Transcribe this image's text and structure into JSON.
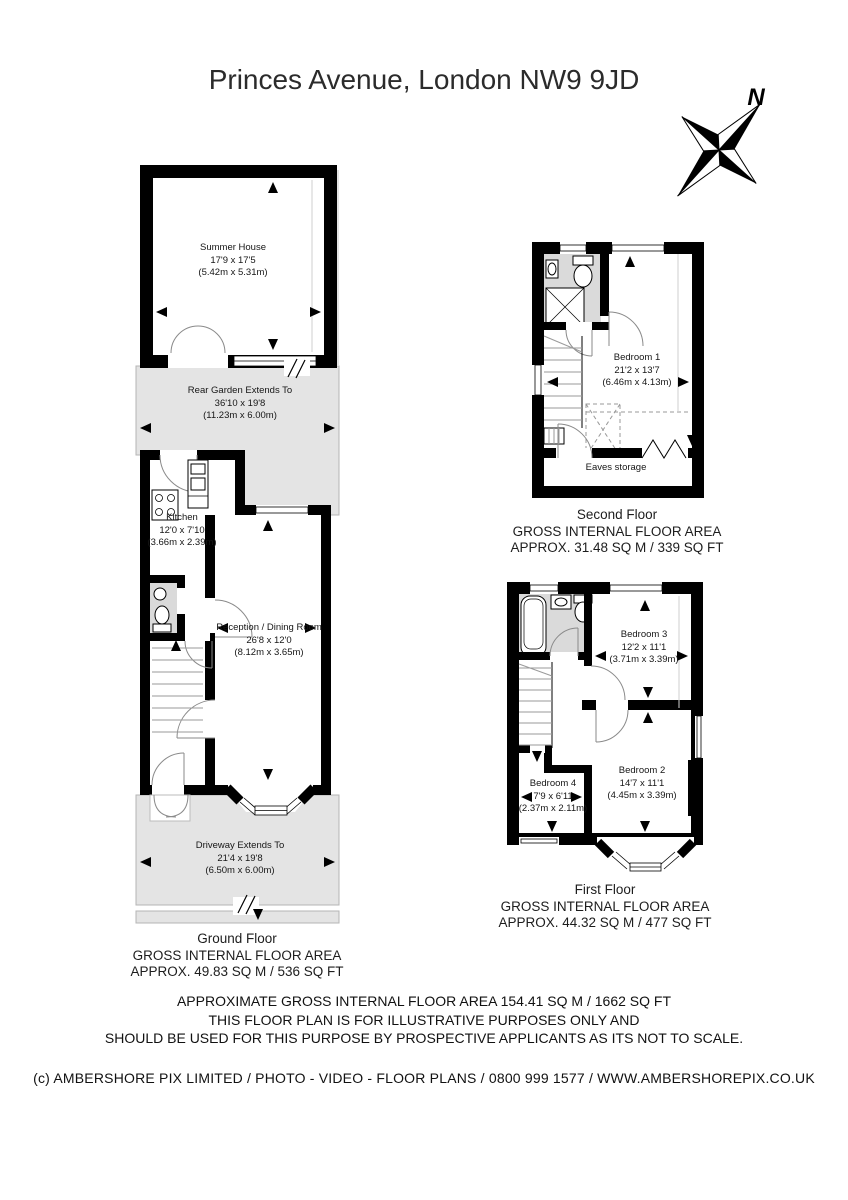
{
  "page": {
    "title": "Princes Avenue, London NW9 9JD"
  },
  "compass": {
    "north_label": "N"
  },
  "ground_floor": {
    "rooms": {
      "summer_house": {
        "name": "Summer House",
        "dims_ft": "17'9 x 17'5",
        "dims_m": "(5.42m x 5.31m)"
      },
      "rear_garden": {
        "name": "Rear Garden Extends To",
        "dims_ft": "36'10 x 19'8",
        "dims_m": "(11.23m x 6.00m)"
      },
      "kitchen": {
        "name": "Kitchen",
        "dims_ft": "12'0 x 7'10",
        "dims_m": "(3.66m x 2.39m)"
      },
      "reception": {
        "name": "Reception / Dining Room",
        "dims_ft": "26'8 x 12'0",
        "dims_m": "(8.12m x 3.65m)"
      },
      "driveway": {
        "name": "Driveway Extends To",
        "dims_ft": "21'4 x 19'8",
        "dims_m": "(6.50m x 6.00m)"
      }
    },
    "label": {
      "floor": "Ground Floor",
      "area_line1": "GROSS INTERNAL FLOOR AREA",
      "area_line2": "APPROX. 49.83 SQ M / 536 SQ FT"
    }
  },
  "second_floor": {
    "rooms": {
      "bedroom_1": {
        "name": "Bedroom 1",
        "dims_ft": "21'2 x 13'7",
        "dims_m": "(6.46m x 4.13m)"
      },
      "eaves_storage": {
        "name": "Eaves storage"
      }
    },
    "label": {
      "floor": "Second Floor",
      "area_line1": "GROSS INTERNAL FLOOR AREA",
      "area_line2": "APPROX. 31.48 SQ M / 339 SQ FT"
    }
  },
  "first_floor": {
    "rooms": {
      "bedroom_3": {
        "name": "Bedroom 3",
        "dims_ft": "12'2 x 11'1",
        "dims_m": "(3.71m x 3.39m)"
      },
      "bedroom_4": {
        "name": "Bedroom 4",
        "dims_ft": "7'9 x 6'11",
        "dims_m": "(2.37m x 2.11m)"
      },
      "bedroom_2": {
        "name": "Bedroom 2",
        "dims_ft": "14'7 x 11'1",
        "dims_m": "(4.45m x 3.39m)"
      }
    },
    "label": {
      "floor": "First Floor",
      "area_line1": "GROSS INTERNAL FLOOR AREA",
      "area_line2": "APPROX. 44.32 SQ M / 477 SQ FT"
    }
  },
  "disclaimer": {
    "line1": "APPROXIMATE GROSS INTERNAL FLOOR AREA 154.41 SQ M / 1662 SQ FT",
    "line2": "THIS FLOOR PLAN IS FOR ILLUSTRATIVE PURPOSES ONLY AND",
    "line3": "SHOULD BE USED FOR THIS PURPOSE BY PROSPECTIVE APPLICANTS AS ITS NOT TO SCALE."
  },
  "footer": {
    "copyright": "(c) AMBERSHORE PIX LIMITED / PHOTO - VIDEO - FLOOR PLANS / 0800 999 1577 / WWW.AMBERSHOREPIX.CO.UK"
  },
  "colors": {
    "wall": "#000000",
    "outdoor_fill": "#e4e4e4",
    "bathroom_fill": "#dadada"
  }
}
